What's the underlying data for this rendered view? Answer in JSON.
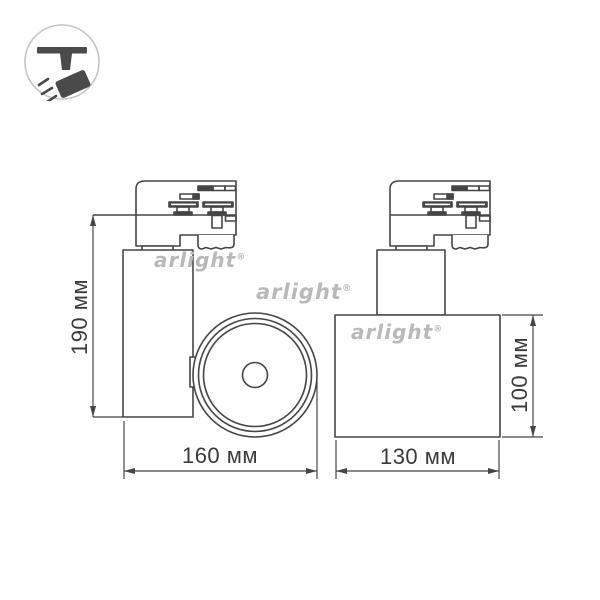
{
  "brand": {
    "name": "arlight",
    "registered": "®"
  },
  "icon": {
    "label": "track-spotlight"
  },
  "drawing": {
    "title": "track light fixture dimensional drawing",
    "side_view": {
      "height_label": "190 мм",
      "width_label": "160 мм"
    },
    "front_view": {
      "height_label": "100 мм",
      "width_label": "130 мм"
    }
  },
  "colors": {
    "line": "#454545",
    "dimension_text": "#3a3a3a",
    "watermark": "#b9b9b9",
    "icon_fill": "#4a4a4a",
    "icon_circle": "#c5c5c5",
    "background": "#ffffff"
  }
}
